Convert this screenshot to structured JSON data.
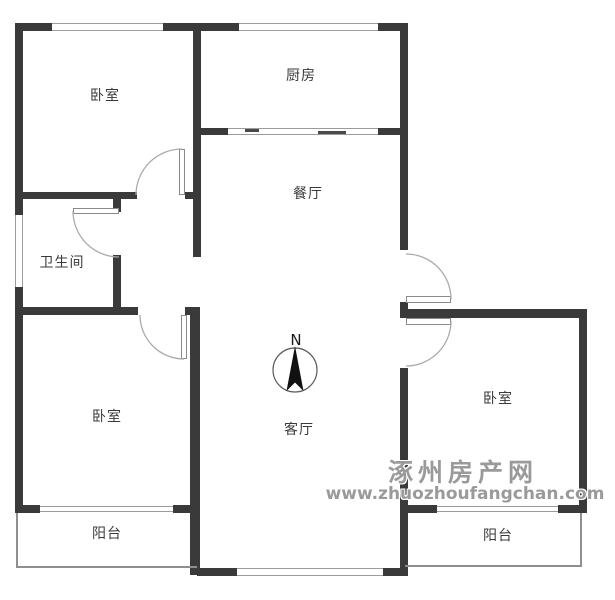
{
  "rooms": [
    {
      "name": "bedroom-top-left",
      "label": "卧室"
    },
    {
      "name": "kitchen",
      "label": "厨房"
    },
    {
      "name": "dining",
      "label": "餐厅"
    },
    {
      "name": "bathroom",
      "label": "卫生间"
    },
    {
      "name": "bedroom-bottom-left",
      "label": "卧室"
    },
    {
      "name": "living",
      "label": "客厅"
    },
    {
      "name": "bedroom-right",
      "label": "卧室"
    },
    {
      "name": "balcony-left",
      "label": "阳台"
    },
    {
      "name": "balcony-right",
      "label": "阳台"
    }
  ],
  "compass": {
    "label": "N"
  },
  "watermark": {
    "site": "涿州房产网",
    "url": "www.zhuozhoufangchan.com"
  },
  "colors": {
    "wall": "#3a3a3a",
    "window_line": "#9c9c9c",
    "door_arc": "#aaaaaa",
    "label_text": "#3a3a3a",
    "watermark_gray": "#9a9a9a",
    "background": "#ffffff"
  }
}
